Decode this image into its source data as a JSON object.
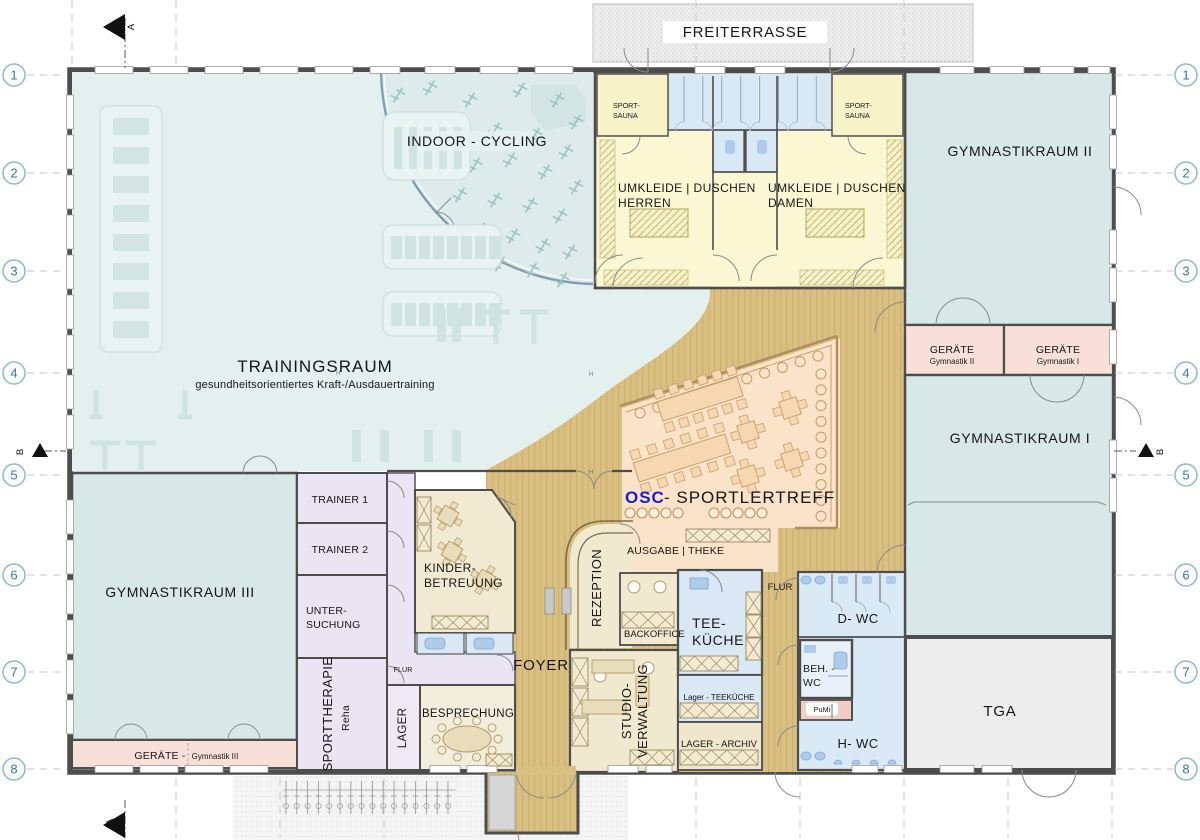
{
  "plan": {
    "terrace": "FREITERRASSE",
    "training": {
      "name": "TRAININGSRAUM",
      "subtitle": "gesundheitsorientiertes Kraft-/Ausdauertraining"
    },
    "cycling": "INDOOR - CYCLING",
    "sauna_left": {
      "l1": "SPORT-",
      "l2": "SAUNA"
    },
    "sauna_right": {
      "l1": "SPORT-",
      "l2": "SAUNA"
    },
    "umkleide_h": {
      "l1": "UMKLEIDE | DUSCHEN",
      "l2": "HERREN"
    },
    "umkleide_d": {
      "l1": "UMKLEIDE | DUSCHEN",
      "l2": "DAMEN"
    },
    "gym2": "GYMNASTIKRAUM II",
    "gym1": "GYMNASTIKRAUM I",
    "gym3": "GYMNASTIKRAUM III",
    "geraete2": {
      "l1": "GERÄTE",
      "l2": "Gymnastik II"
    },
    "geraete1": {
      "l1": "GERÄTE",
      "l2": "Gymnastik I"
    },
    "geraete3": {
      "l1": "GERÄTE  -",
      "l2": "Gymnastik III"
    },
    "osc": {
      "brand": "OSC",
      "rest": "-  SPORTLERTREFF"
    },
    "ausgabe": "AUSGABE  |  THEKE",
    "rezeption": "REZEPTION",
    "backoffice": "BACKOFFICE",
    "studio": {
      "l1": "STUDIO-",
      "l2": "VERWALTUNG"
    },
    "teekueche": {
      "l1": "TEE-",
      "l2": "KÜCHE"
    },
    "lager_teekueche": "Lager - TEEKÜCHE",
    "lager_archiv": "LAGER - ARCHIV",
    "flur_right": "FLUR",
    "flur_left": "FLUR",
    "dwc": "D- WC",
    "behwc": {
      "l1": "BEH. -",
      "l2": "WC"
    },
    "pumi": "PuMi",
    "hwc": "H- WC",
    "tga": "TGA",
    "trainer1": "TRAINER 1",
    "trainer2": "TRAINER 2",
    "untersuchung": {
      "l1": "UNTER-",
      "l2": "SUCHUNG"
    },
    "sporttherapie": {
      "l1": "SPORTTHERAPIE",
      "l2": "Reha"
    },
    "lager": "LAGER",
    "kinder": {
      "l1": "KINDER-",
      "l2": "BETREUUNG"
    },
    "besprechung": "BESPRECHUNG",
    "foyer": "FOYER",
    "h_marker": "H"
  },
  "grid": {
    "rows": [
      "1",
      "2",
      "3",
      "4",
      "5",
      "6",
      "7",
      "8"
    ],
    "section_a": "A",
    "section_b": "B"
  },
  "colors": {
    "accent_blue": "#1b1bd4",
    "teal": "#e3f0ed",
    "teal_room": "#d7e8e6",
    "tan": "#d9bf82",
    "peach": "#fbe3c9",
    "yellow": "#faf7d2",
    "lavender": "#e9e5f3",
    "lightblue": "#d9e8f5",
    "pink": "#f8e0d8",
    "cream": "#f1e8d0",
    "gray": "#ededee",
    "wall": "#4d4d4d"
  }
}
